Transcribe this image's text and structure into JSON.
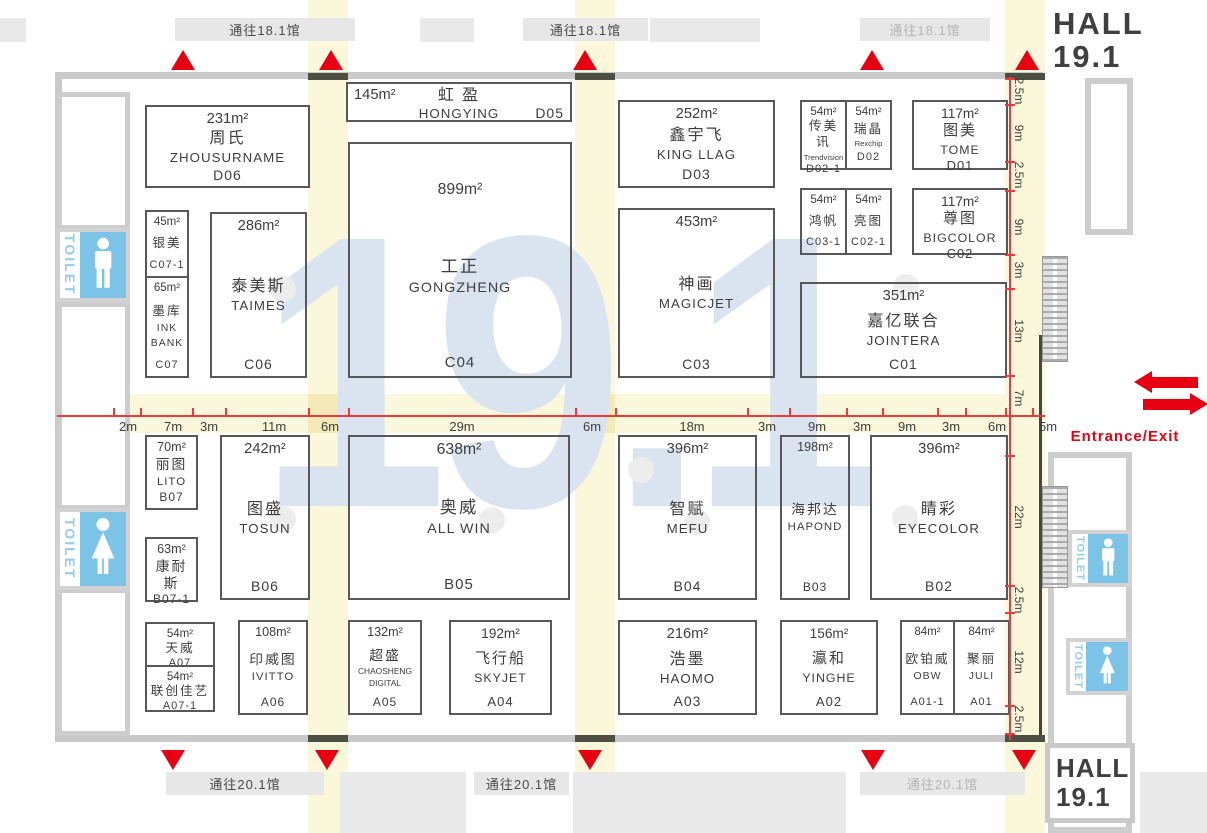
{
  "watermark": "19.1",
  "hall": {
    "line1": "HALL",
    "line2": "19.1"
  },
  "entrance_label": "Entrance/Exit",
  "toilet_label": "TOILET",
  "colors": {
    "red": "#e60012",
    "aisle_yellow": "#fbf7da",
    "aisle_deep": "#f3eab8",
    "watermark_blue": "#dae4f1",
    "toilet_blue": "#7cc3e8",
    "toilet_text": "#8fcdec",
    "wall_gray": "#c9c9c9",
    "booth_border": "#58585a",
    "door_olive": "#4c4f41"
  },
  "passages_top": [
    {
      "text": "通往18.1馆",
      "x": 175,
      "w": 180,
      "faint": false
    },
    {
      "text": "通往18.1馆",
      "x": 523,
      "w": 125,
      "faint": false
    },
    {
      "text": "通往18.1馆",
      "x": 860,
      "w": 130,
      "faint": true
    }
  ],
  "passages_bottom": [
    {
      "text": "通往20.1馆",
      "x": 166,
      "w": 158,
      "faint": false
    },
    {
      "text": "通往20.1馆",
      "x": 474,
      "w": 95,
      "faint": false
    },
    {
      "text": "通往20.1馆",
      "x": 860,
      "w": 165,
      "faint": true
    }
  ],
  "triangles_top": [
    183,
    331,
    585,
    872,
    1027
  ],
  "triangles_bottom": [
    173,
    327,
    590,
    873,
    1024
  ],
  "h_dims": [
    [
      "2m",
      128
    ],
    [
      "7m",
      173
    ],
    [
      "3m",
      209
    ],
    [
      "11m",
      274
    ],
    [
      "6m",
      330
    ],
    [
      "29m",
      462
    ],
    [
      "6m",
      592
    ],
    [
      "18m",
      692
    ],
    [
      "3m",
      767
    ],
    [
      "9m",
      817
    ],
    [
      "3m",
      862
    ],
    [
      "9m",
      907
    ],
    [
      "3m",
      951
    ],
    [
      "6m",
      997
    ],
    [
      "5m",
      1048
    ]
  ],
  "v_dims": [
    [
      "2.5m",
      91
    ],
    [
      "9m",
      133
    ],
    [
      "2.5m",
      175
    ],
    [
      "9m",
      227
    ],
    [
      "3m",
      270
    ],
    [
      "13m",
      331
    ],
    [
      "7m",
      398
    ],
    [
      "22m",
      517
    ],
    [
      "2.5m",
      600
    ],
    [
      "12m",
      662
    ],
    [
      "2.5m",
      719
    ]
  ],
  "h_ticks": [
    113,
    140,
    192,
    225,
    308,
    348,
    575,
    615,
    747,
    789,
    846,
    882,
    937,
    965,
    1005,
    1032
  ],
  "v_ticks": [
    78,
    104,
    161,
    190,
    254,
    288,
    375,
    455,
    585,
    612,
    705,
    733
  ],
  "booths": [
    {
      "code": "D06",
      "x": 145,
      "y": 105,
      "w": 165,
      "h": 83,
      "fs": 14,
      "area": "231m²",
      "lines": [
        [
          "周氏",
          "cn"
        ],
        [
          "ZHOUSURNAME",
          "en"
        ]
      ]
    },
    {
      "code": "D05",
      "layout": "wide",
      "x": 346,
      "y": 82,
      "w": 226,
      "h": 40,
      "fs": 14,
      "area": "145m²",
      "cn": "虹盈",
      "en": "HONGYING"
    },
    {
      "code": "C04",
      "x": 348,
      "y": 142,
      "w": 224,
      "h": 236,
      "fs": 15,
      "pt": 36,
      "area": "899m²",
      "lines": [
        [
          "工正",
          "cn"
        ],
        [
          "GONGZHENG",
          "en"
        ]
      ]
    },
    {
      "code": "C07-1",
      "x": 145,
      "y": 210,
      "w": 44,
      "h": 68,
      "fs": 11,
      "area": "45m²",
      "lines": [
        [
          "银美",
          "cn"
        ]
      ]
    },
    {
      "code": "C07",
      "x": 145,
      "y": 276,
      "w": 44,
      "h": 102,
      "fs": 11,
      "area": "65m²",
      "lines": [
        [
          "墨库",
          "cn"
        ],
        [
          "INK",
          "en"
        ],
        [
          "BANK",
          "en"
        ]
      ]
    },
    {
      "code": "C06",
      "x": 210,
      "y": 212,
      "w": 97,
      "h": 166,
      "fs": 14,
      "area": "286m²",
      "lines": [
        [
          "泰美斯",
          "cn"
        ],
        [
          "TAIMES",
          "en"
        ]
      ]
    },
    {
      "code": "D03",
      "x": 618,
      "y": 100,
      "w": 157,
      "h": 88,
      "fs": 14,
      "area": "252m²",
      "lines": [
        [
          "鑫宇飞",
          "cn"
        ],
        [
          "KING LLAG",
          "en"
        ]
      ]
    },
    {
      "code": "C03",
      "x": 618,
      "y": 208,
      "w": 157,
      "h": 170,
      "fs": 14,
      "area": "453m²",
      "lines": [
        [
          "神画",
          "cn"
        ],
        [
          "MAGICJET",
          "en"
        ]
      ]
    },
    {
      "code": "D02-1",
      "x": 800,
      "y": 100,
      "w": 47,
      "h": 70,
      "fs": 11,
      "area": "54m²",
      "lines": [
        [
          "传美讯",
          "cn"
        ],
        [
          "Trendvision",
          "sub"
        ]
      ]
    },
    {
      "code": "D02",
      "x": 845,
      "y": 100,
      "w": 47,
      "h": 70,
      "fs": 11,
      "area": "54m²",
      "lines": [
        [
          "瑞晶",
          "cn"
        ],
        [
          "Rexchip",
          "sub"
        ]
      ]
    },
    {
      "code": "D01",
      "x": 912,
      "y": 100,
      "w": 96,
      "h": 70,
      "fs": 13,
      "area": "117m²",
      "lines": [
        [
          "图美",
          "cn"
        ],
        [
          "TOME",
          "en"
        ]
      ]
    },
    {
      "code": "C03-1",
      "x": 800,
      "y": 188,
      "w": 47,
      "h": 67,
      "fs": 11,
      "area": "54m²",
      "lines": [
        [
          "鸿帆",
          "cn"
        ]
      ]
    },
    {
      "code": "C02-1",
      "x": 845,
      "y": 188,
      "w": 47,
      "h": 67,
      "fs": 11,
      "area": "54m²",
      "lines": [
        [
          "亮图",
          "cn"
        ]
      ]
    },
    {
      "code": "C02",
      "x": 912,
      "y": 188,
      "w": 96,
      "h": 67,
      "fs": 13,
      "area": "117m²",
      "lines": [
        [
          "尊图",
          "cn"
        ],
        [
          "BIGCOLOR",
          "en"
        ]
      ]
    },
    {
      "code": "C01",
      "x": 800,
      "y": 282,
      "w": 207,
      "h": 96,
      "fs": 14,
      "area": "351m²",
      "lines": [
        [
          "嘉亿联合",
          "cn"
        ],
        [
          "JOINTERA",
          "en"
        ]
      ]
    },
    {
      "code": "B07",
      "x": 145,
      "y": 435,
      "w": 53,
      "h": 75,
      "fs": 12,
      "area": "70m²",
      "lines": [
        [
          "丽图",
          "cn"
        ],
        [
          "LITO",
          "en"
        ]
      ]
    },
    {
      "code": "B07-1",
      "x": 145,
      "y": 537,
      "w": 53,
      "h": 65,
      "fs": 12,
      "area": "63m²",
      "lines": [
        [
          "康耐斯",
          "cn"
        ]
      ]
    },
    {
      "code": "B06",
      "x": 220,
      "y": 435,
      "w": 90,
      "h": 165,
      "fs": 14,
      "area": "242m²",
      "lines": [
        [
          "图盛",
          "cn"
        ],
        [
          "TOSUN",
          "en"
        ]
      ]
    },
    {
      "code": "B05",
      "x": 348,
      "y": 435,
      "w": 222,
      "h": 165,
      "fs": 15,
      "area": "638m²",
      "lines": [
        [
          "奥威",
          "cn"
        ],
        [
          "ALL WIN",
          "en"
        ]
      ]
    },
    {
      "code": "B04",
      "x": 618,
      "y": 435,
      "w": 139,
      "h": 165,
      "fs": 14,
      "area": "396m²",
      "lines": [
        [
          "智赋",
          "cn"
        ],
        [
          "MEFU",
          "en"
        ]
      ]
    },
    {
      "code": "B03",
      "x": 780,
      "y": 435,
      "w": 70,
      "h": 165,
      "fs": 12,
      "area": "198m²",
      "lines": [
        [
          "海邦达",
          "cn"
        ],
        [
          "HAPOND",
          "en"
        ]
      ]
    },
    {
      "code": "B02",
      "x": 870,
      "y": 435,
      "w": 138,
      "h": 165,
      "fs": 14,
      "area": "396m²",
      "lines": [
        [
          "睛彩",
          "cn"
        ],
        [
          "EYECOLOR",
          "en"
        ]
      ]
    },
    {
      "code": "A07",
      "x": 145,
      "y": 622,
      "w": 70,
      "h": 45,
      "fs": 11,
      "area": "54m²",
      "lines": [
        [
          "天威",
          "cn"
        ]
      ]
    },
    {
      "code": "A07-1",
      "x": 145,
      "y": 665,
      "w": 70,
      "h": 47,
      "fs": 11,
      "area": "54m²",
      "lines": [
        [
          "联创佳艺",
          "cn"
        ]
      ]
    },
    {
      "code": "A06",
      "x": 238,
      "y": 620,
      "w": 70,
      "h": 95,
      "fs": 12,
      "area": "108m²",
      "lines": [
        [
          "印威图",
          "cn"
        ],
        [
          "IVITTO",
          "en"
        ]
      ]
    },
    {
      "code": "A05",
      "x": 348,
      "y": 620,
      "w": 74,
      "h": 95,
      "fs": 12,
      "area": "132m²",
      "lines": [
        [
          "超盛",
          "cn"
        ],
        [
          "CHAOSHENG",
          "sub"
        ],
        [
          "DIGITAL",
          "sub"
        ]
      ]
    },
    {
      "code": "A04",
      "x": 449,
      "y": 620,
      "w": 103,
      "h": 95,
      "fs": 13,
      "area": "192m²",
      "lines": [
        [
          "飞行船",
          "cn"
        ],
        [
          "SKYJET",
          "en"
        ]
      ]
    },
    {
      "code": "A03",
      "x": 618,
      "y": 620,
      "w": 139,
      "h": 95,
      "fs": 14,
      "area": "216m²",
      "lines": [
        [
          "浩墨",
          "cn"
        ],
        [
          "HAOMO",
          "en"
        ]
      ]
    },
    {
      "code": "A02",
      "x": 780,
      "y": 620,
      "w": 98,
      "h": 95,
      "fs": 13,
      "area": "156m²",
      "lines": [
        [
          "瀛和",
          "cn"
        ],
        [
          "YINGHE",
          "en"
        ]
      ]
    },
    {
      "code": "A01-1",
      "x": 900,
      "y": 620,
      "w": 55,
      "h": 95,
      "fs": 11,
      "area": "84m²",
      "lines": [
        [
          "欧铂威",
          "cn"
        ],
        [
          "OBW",
          "en"
        ]
      ]
    },
    {
      "code": "A01",
      "x": 953,
      "y": 620,
      "w": 57,
      "h": 95,
      "fs": 11,
      "area": "84m²",
      "lines": [
        [
          "聚丽",
          "cn"
        ],
        [
          "JULI",
          "en"
        ]
      ]
    }
  ],
  "toilets": [
    {
      "gender": "male",
      "x": 56,
      "y": 228,
      "w": 74,
      "h": 74,
      "small": false
    },
    {
      "gender": "female",
      "x": 56,
      "y": 508,
      "w": 74,
      "h": 82,
      "small": false
    },
    {
      "gender": "male",
      "x": 1068,
      "y": 530,
      "w": 64,
      "h": 57,
      "small": true
    },
    {
      "gender": "female",
      "x": 1066,
      "y": 638,
      "w": 66,
      "h": 57,
      "small": true
    }
  ],
  "escalators": [
    {
      "x": 1042,
      "y": 256,
      "w": 26,
      "h": 106
    },
    {
      "x": 1042,
      "y": 486,
      "w": 26,
      "h": 102
    }
  ],
  "pillars": [
    [
      283,
      289
    ],
    [
      906,
      287
    ],
    [
      641,
      470
    ],
    [
      283,
      519
    ],
    [
      492,
      520
    ],
    [
      697,
      522
    ],
    [
      905,
      518
    ]
  ]
}
